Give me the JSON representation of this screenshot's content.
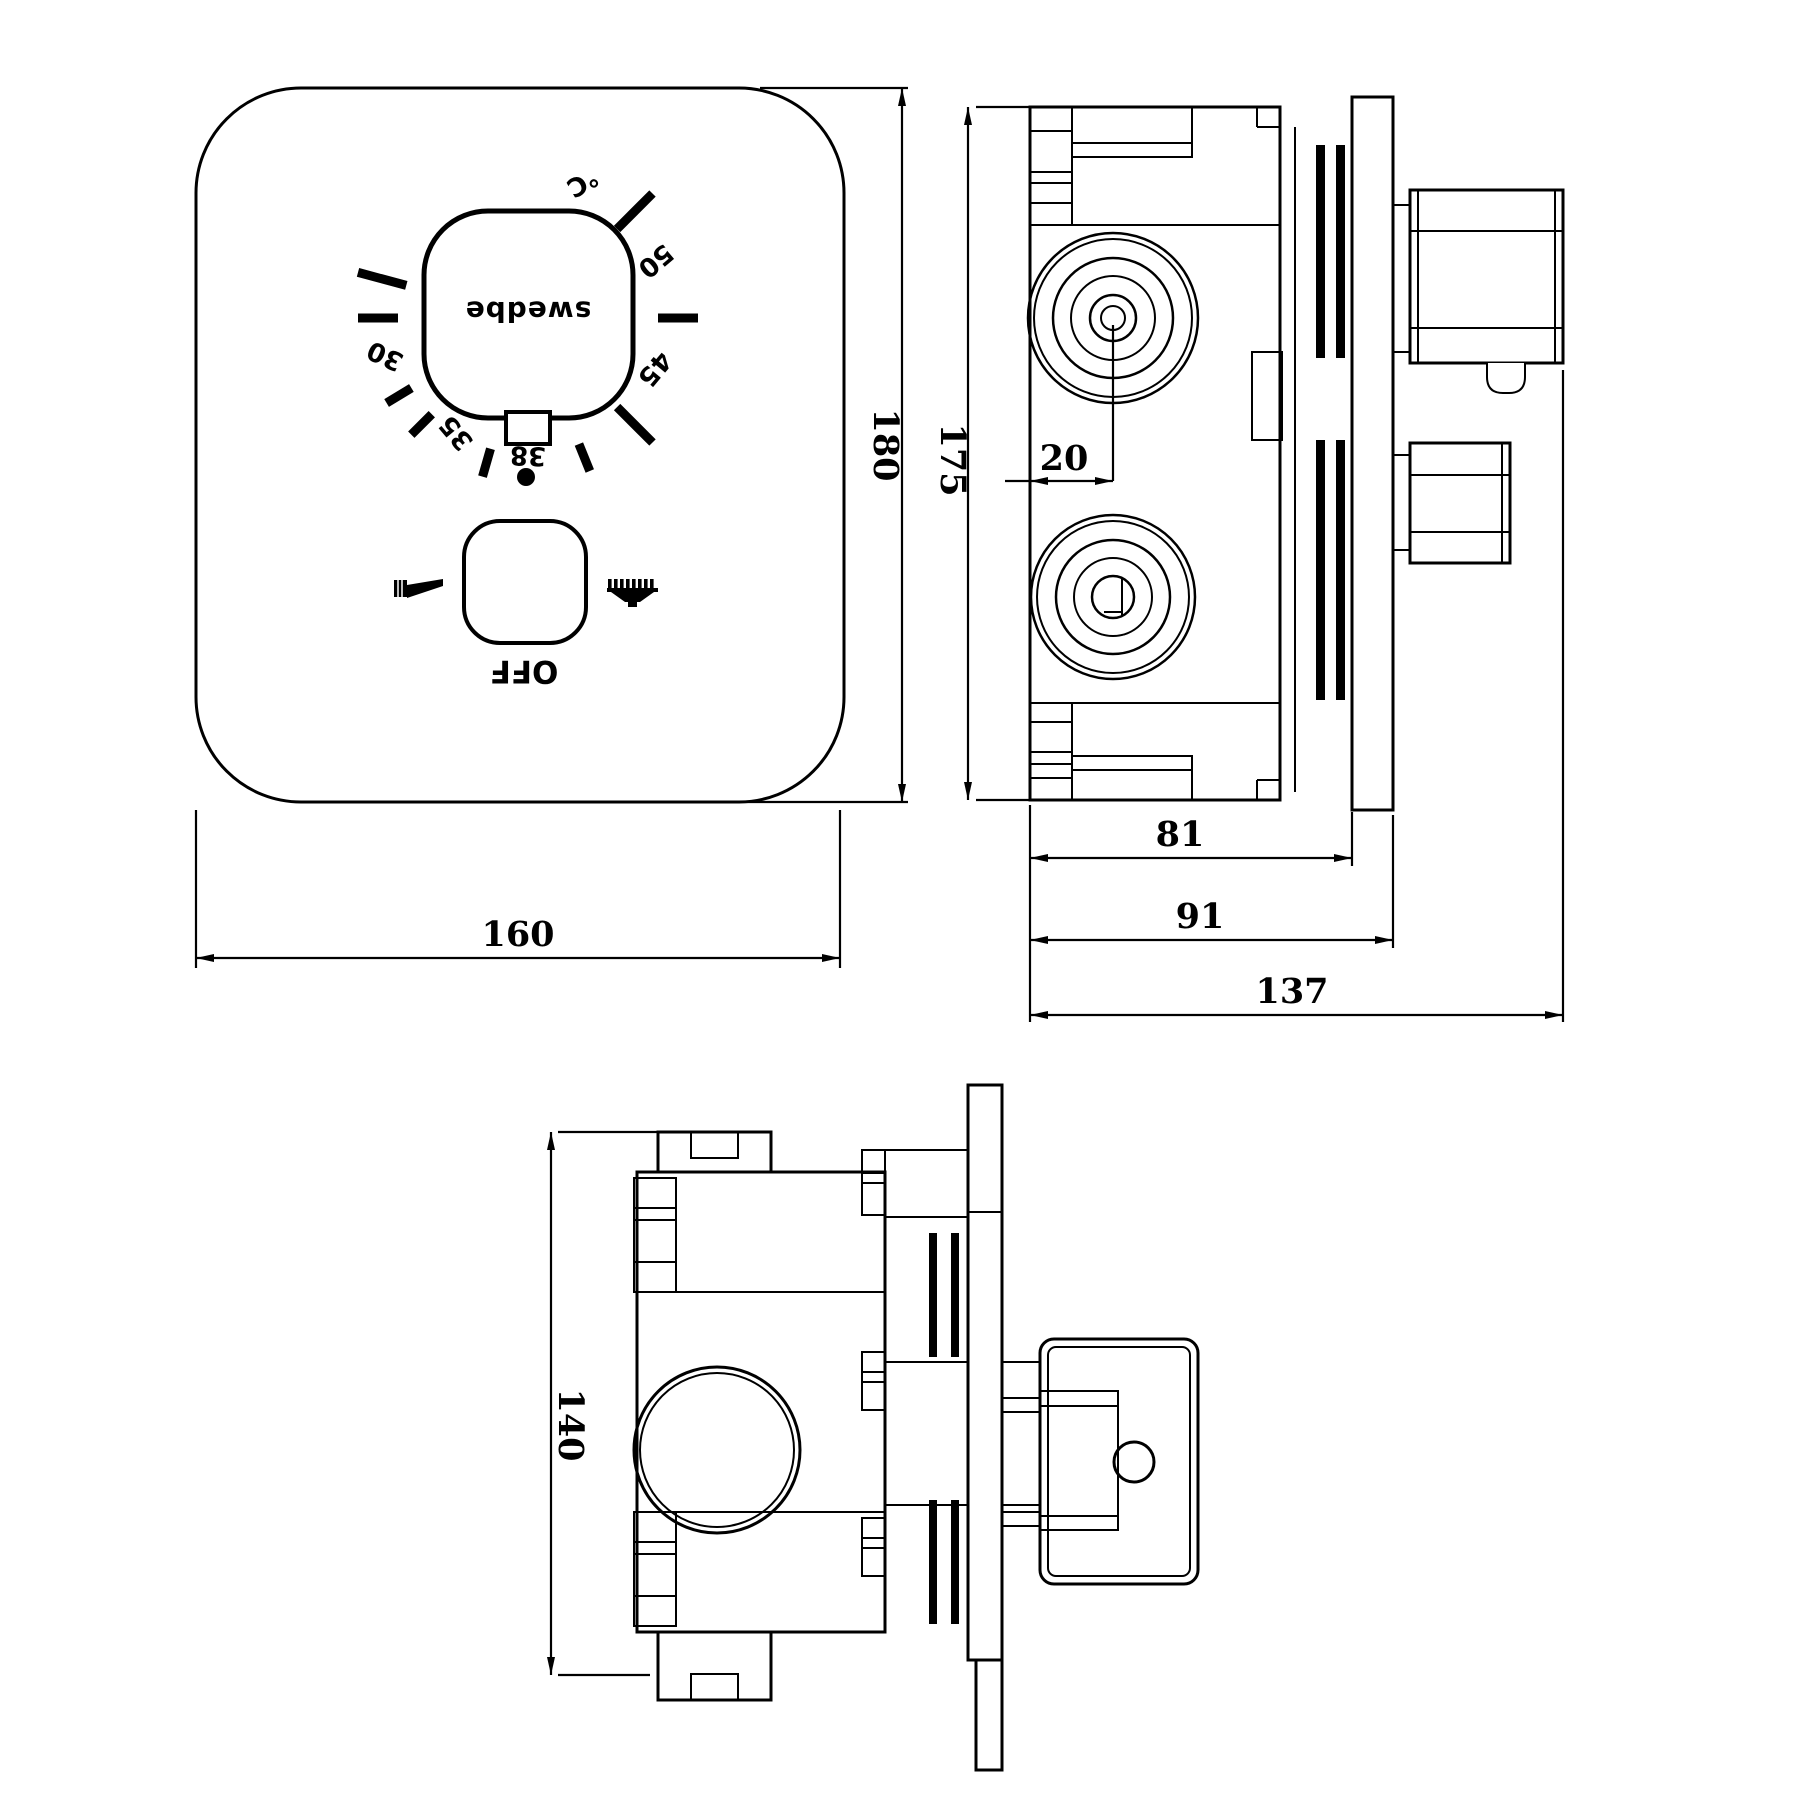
{
  "front_view": {
    "dial": {
      "brand_label": "swedbe",
      "ticks": [
        {
          "angle": -165,
          "len": "long"
        },
        {
          "angle": 180,
          "len": "med"
        },
        {
          "angle": 149,
          "len": "short"
        },
        {
          "angle": 135,
          "len": "short"
        },
        {
          "angle": 106,
          "len": "short"
        },
        {
          "angle": 68,
          "len": "short"
        },
        {
          "angle": 45,
          "len": "long"
        },
        {
          "angle": 0,
          "len": "med"
        },
        {
          "angle": -45,
          "len": "long"
        }
      ],
      "temp_labels": [
        {
          "text": "30",
          "angle": 165,
          "r": 148,
          "rot": 205
        },
        {
          "text": "35",
          "angle": 122,
          "r": 136,
          "rot": 230
        },
        {
          "text": "38",
          "angle": 90,
          "r": 138,
          "rot": 182
        },
        {
          "text": "45",
          "angle": 22,
          "r": 137,
          "rot": 130
        },
        {
          "text": "50",
          "angle": -24,
          "r": 140,
          "rot": 140
        },
        {
          "text": "℃",
          "angle": -68,
          "r": 146,
          "rot": 150
        }
      ]
    },
    "control": {
      "off_label": "OFF"
    },
    "dims": {
      "width": "160",
      "height": "180"
    }
  },
  "side_view": {
    "dims": {
      "height": "175",
      "port_offset": "20",
      "depth_box": "81",
      "depth_plate": "91",
      "depth_total": "137"
    }
  },
  "bottom_view": {
    "dims": {
      "height": "140"
    }
  }
}
